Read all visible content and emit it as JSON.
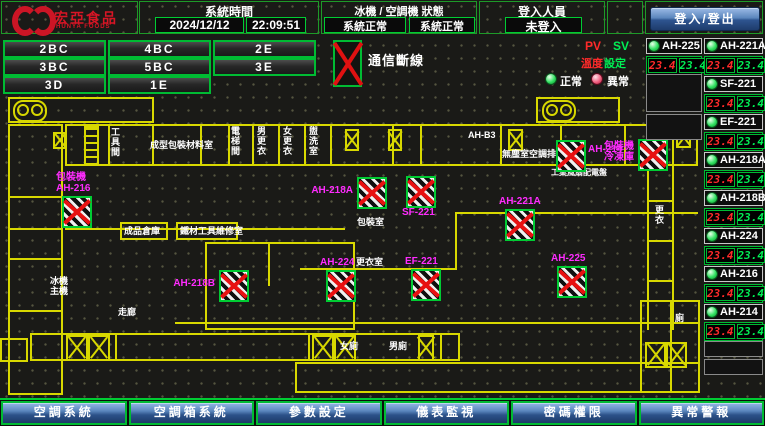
{
  "header": {
    "logo": {
      "title": "宏亞食品",
      "subtitle": "HUNYA FOODS"
    },
    "system_time": {
      "label": "系統時間",
      "date": "2024/12/12",
      "time": "22:09:51"
    },
    "status": {
      "label": "冰機 / 空調機 狀態",
      "status1": "系統正常",
      "status2": "系統正常"
    },
    "login": {
      "label": "登入人員",
      "value": "未登入",
      "button": "登入/登出"
    }
  },
  "floor_buttons": [
    {
      "label": "2BC"
    },
    {
      "label": "4BC"
    },
    {
      "label": "2E"
    },
    {
      "label": "3BC"
    },
    {
      "label": "5BC"
    },
    {
      "label": "3E"
    },
    {
      "label": "3D"
    },
    {
      "label": "1E"
    }
  ],
  "legend": {
    "comm_loss": "通信斷線"
  },
  "right_panel": {
    "pv_header": "PV",
    "sv_header": "SV",
    "pv_sub": "溫度",
    "sv_sub": "設定",
    "normal_label": "正常",
    "abnormal_label": "異常",
    "column_a": [
      {
        "name": "AH-225",
        "pv": "23.4",
        "sv": "23.4"
      }
    ],
    "column_b": [
      {
        "name": "AH-221A",
        "pv": "23.4",
        "sv": "23.4"
      },
      {
        "name": "SF-221",
        "pv": "23.4",
        "sv": "23.4"
      },
      {
        "name": "EF-221",
        "pv": "23.4",
        "sv": "23.4"
      },
      {
        "name": "AH-218A",
        "pv": "23.4",
        "sv": "23.4"
      },
      {
        "name": "AH-218B",
        "pv": "23.4",
        "sv": "23.4"
      },
      {
        "name": "AH-224",
        "pv": "23.4",
        "sv": "23.4"
      },
      {
        "name": "AH-216",
        "pv": "23.4",
        "sv": "23.4"
      },
      {
        "name": "AH-214",
        "pv": "23.4",
        "sv": "23.4"
      }
    ]
  },
  "floorplan": {
    "devices": [
      {
        "label": "包裝機\nAH-216",
        "x": 62,
        "y": 196,
        "label_pos": "above"
      },
      {
        "label": "AH-218A",
        "x": 357,
        "y": 177,
        "label_pos": "left"
      },
      {
        "label": "SF-221",
        "x": 406,
        "y": 176,
        "label_pos": "below"
      },
      {
        "label": "AH-214",
        "x": 556,
        "y": 140,
        "label_pos": "right"
      },
      {
        "label": "包裝機\n冷凍庫",
        "x": 638,
        "y": 139,
        "label_pos": "left"
      },
      {
        "label": "AH-221A",
        "x": 505,
        "y": 209,
        "label_pos": "above"
      },
      {
        "label": "AH-218B",
        "x": 219,
        "y": 270,
        "label_pos": "left"
      },
      {
        "label": "AH-224",
        "x": 326,
        "y": 270,
        "label_pos": "above"
      },
      {
        "label": "EF-221",
        "x": 411,
        "y": 269,
        "label_pos": "above"
      },
      {
        "label": "AH-225",
        "x": 557,
        "y": 266,
        "label_pos": "above"
      }
    ],
    "rooms": [
      {
        "label": "工具間",
        "x": 110,
        "y": 127,
        "vertical": true
      },
      {
        "label": "成型包裝材料室",
        "x": 150,
        "y": 140
      },
      {
        "label": "電梯間",
        "x": 230,
        "y": 126,
        "vertical": true
      },
      {
        "label": "男更衣",
        "x": 256,
        "y": 126,
        "vertical": true
      },
      {
        "label": "女更衣",
        "x": 282,
        "y": 126,
        "vertical": true
      },
      {
        "label": "盥洗室",
        "x": 308,
        "y": 126,
        "vertical": true
      },
      {
        "label": "AH-B3",
        "x": 468,
        "y": 130
      },
      {
        "label": "無塵室空調排風",
        "x": 502,
        "y": 149
      },
      {
        "label": "工業風扇配電盤",
        "x": 551,
        "y": 168,
        "size": 8
      },
      {
        "label": "成品倉庫",
        "x": 124,
        "y": 226
      },
      {
        "label": "鐵材工具維修室",
        "x": 180,
        "y": 226
      },
      {
        "label": "包裝室",
        "x": 357,
        "y": 217
      },
      {
        "label": "更衣室",
        "x": 356,
        "y": 257
      },
      {
        "label": "冰機\n主機",
        "x": 50,
        "y": 276
      },
      {
        "label": "走廊",
        "x": 118,
        "y": 307
      },
      {
        "label": "女廁",
        "x": 340,
        "y": 341
      },
      {
        "label": "男廁",
        "x": 389,
        "y": 341
      },
      {
        "label": "更衣",
        "x": 654,
        "y": 205,
        "vertical": true
      },
      {
        "label": "廁",
        "x": 675,
        "y": 313
      }
    ],
    "symbols": [
      {
        "type": "stairs",
        "x": 13,
        "y": 100
      },
      {
        "type": "stairs",
        "x": 542,
        "y": 100
      },
      {
        "type": "ladder",
        "x": 84,
        "y": 126
      },
      {
        "type": "x",
        "x": 53,
        "y": 132,
        "w": 13,
        "h": 17
      },
      {
        "type": "x",
        "x": 345,
        "y": 129,
        "w": 14,
        "h": 22
      },
      {
        "type": "x",
        "x": 388,
        "y": 129,
        "w": 14,
        "h": 22
      },
      {
        "type": "x",
        "x": 508,
        "y": 129,
        "w": 15,
        "h": 22
      },
      {
        "type": "x",
        "x": 676,
        "y": 127,
        "w": 15,
        "h": 21
      },
      {
        "type": "x",
        "x": 66,
        "y": 335,
        "w": 22,
        "h": 26
      },
      {
        "type": "x",
        "x": 88,
        "y": 335,
        "w": 22,
        "h": 26
      },
      {
        "type": "x",
        "x": 312,
        "y": 335,
        "w": 22,
        "h": 26
      },
      {
        "type": "x",
        "x": 334,
        "y": 335,
        "w": 22,
        "h": 26
      },
      {
        "type": "x",
        "x": 418,
        "y": 335,
        "w": 16,
        "h": 26
      },
      {
        "type": "x",
        "x": 645,
        "y": 342,
        "w": 21,
        "h": 26
      },
      {
        "type": "x",
        "x": 666,
        "y": 342,
        "w": 21,
        "h": 26
      }
    ]
  },
  "bottom_menu": [
    {
      "label": "空調系統"
    },
    {
      "label": "空調箱系統"
    },
    {
      "label": "參數設定"
    },
    {
      "label": "儀表監視"
    },
    {
      "label": "密碼權限"
    },
    {
      "label": "異常警報"
    }
  ],
  "colors": {
    "accent_green": "#00cc33",
    "wall_yellow": "#d8d800",
    "device_magenta": "#ff2bff",
    "pv_red": "#ff2a2a",
    "sv_green": "#00ef55",
    "button_blue": "#2c5189",
    "logo_red": "#d81525"
  }
}
